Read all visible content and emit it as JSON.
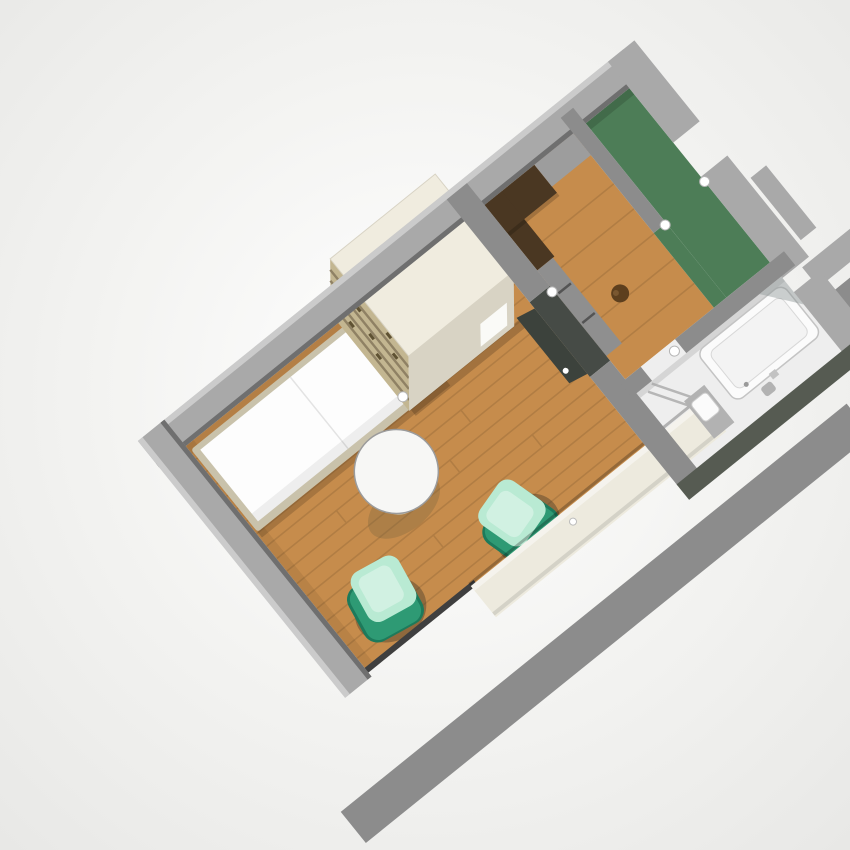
{
  "scene": {
    "type": "3d-floorplan-render",
    "view": "axonometric-top-down",
    "rotation_deg": -38.9,
    "description": "Rendered 3D model of a studio apartment floor plan on a white background"
  },
  "rooms": [
    {
      "id": "living-bedroom",
      "floor": "wood"
    },
    {
      "id": "kitchen-hall",
      "floor": "wood"
    },
    {
      "id": "entry",
      "floor": "green"
    },
    {
      "id": "bathroom",
      "floor": "white"
    }
  ],
  "objects": [
    "bed",
    "wardrobe-shelf-unit",
    "round-side-table",
    "armchair-left",
    "armchair-right",
    "window-sill-ledge",
    "interior-door",
    "kitchen-counter",
    "kitchen-cabinets",
    "bar-stool",
    "bathtub",
    "shower-screen",
    "vanity-sink",
    "toilet",
    "wall-lamps",
    "outer-balcony-wall",
    "neighbor-wall-segments"
  ],
  "colors": {
    "background": "#f3f3f1",
    "vignette_edge": "#e8e8e6",
    "wall_top": "#a9a9a9",
    "wall_side": "#8c8c8c",
    "wall_dark": "#6f6f6f",
    "wall_deep": "#464b46",
    "wall_olive": "#565b52",
    "wall_outer_stripe": "#8c8c8c",
    "floor_wood": "#c68c4c",
    "floor_green": "#4d7d57",
    "floor_bath": "#eeeeee",
    "wardrobe_top": "#f0ecdf",
    "wardrobe_side": "#d8d3c4",
    "wardrobe_shelf": "#c3b691",
    "shelf_stripe": "#8f8164",
    "shelf_dash": "#5f5233",
    "bed_frame": "#c9c2ab",
    "mattress": "#fdfdfd",
    "sill": "#edeade",
    "table_top": "#f7f7f5",
    "table_base": "#cbc0a4",
    "shadow_brown": "#6d5c3c",
    "chair_dark": "#1d7a5b",
    "chair_mid": "#2e9a74",
    "chair_light": "#b9ead3",
    "counter_dark": "#4a3722",
    "counter_gray": "#9d9d9d",
    "cabinet_gray": "#8f8f8f",
    "stool": "#5d3f1e",
    "door_panel": "#3c423c",
    "fixture_white": "#fbfbfb",
    "fixture_gray": "#b2b2b2",
    "glass": "#8f9696",
    "lamp": "#ffffff"
  }
}
